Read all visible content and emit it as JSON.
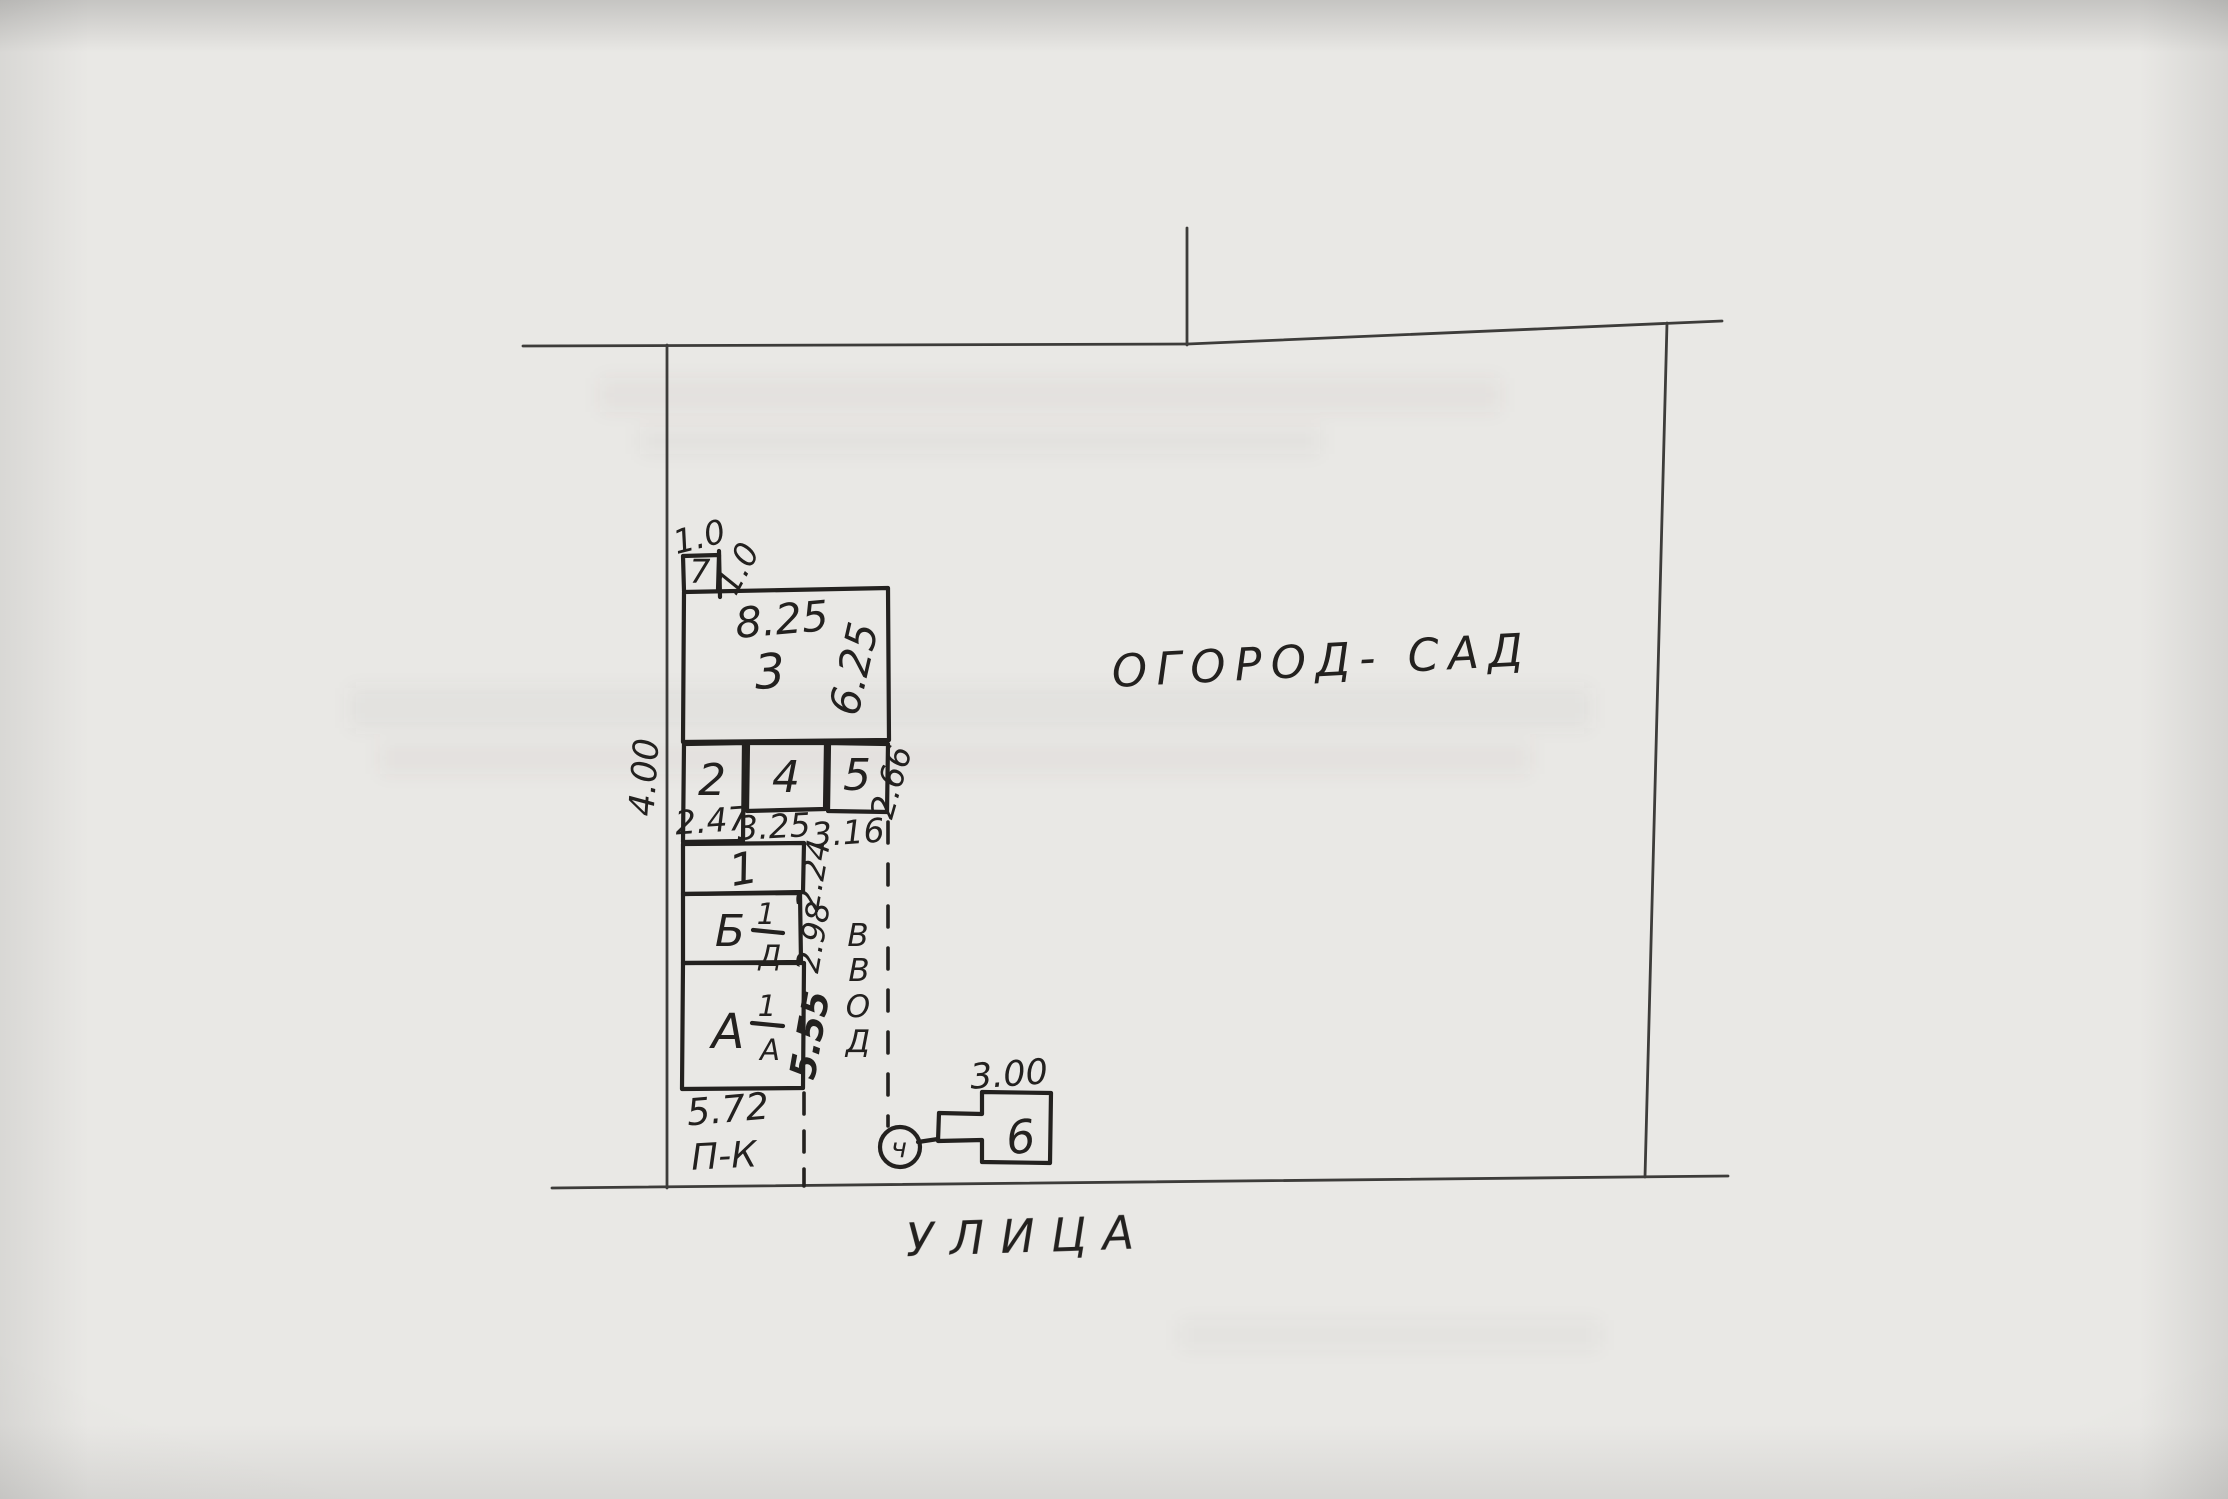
{
  "document": {
    "kind_label": "hand-drawn site plan",
    "paper_color": "#e9e8e5",
    "ink_color": "#23211f"
  },
  "site": {
    "garden_label": "ОГОРОД- САД",
    "street_label": "УЛИЦА",
    "pk_label": "П-К",
    "dim_left_boundary": "4.00",
    "dim_right_boundary": "2.66",
    "utility_word": [
      "В",
      "В",
      "О",
      "Д"
    ],
    "utility_marker_glyph": "ч"
  },
  "buildings": [
    {
      "label": "7",
      "dim_top": "1.0",
      "dim_side": "1.0"
    },
    {
      "label": "3",
      "dim_width": "8.25",
      "dim_height": "6.25"
    },
    {
      "label": "2",
      "dim_width": "2.47"
    },
    {
      "label": "4",
      "dim_width": "3.25"
    },
    {
      "label": "5",
      "dim_width": "3.16"
    },
    {
      "label": "1",
      "dim_height": "2.24"
    },
    {
      "letter": "Б",
      "frac_num": "1",
      "frac_den": "Д",
      "dim_height": "2.98"
    },
    {
      "letter": "А",
      "frac_num": "1",
      "frac_den": "А",
      "dim_height": "5.55",
      "dim_width": "5.72"
    },
    {
      "label": "6",
      "dim_width": "3.00"
    }
  ]
}
